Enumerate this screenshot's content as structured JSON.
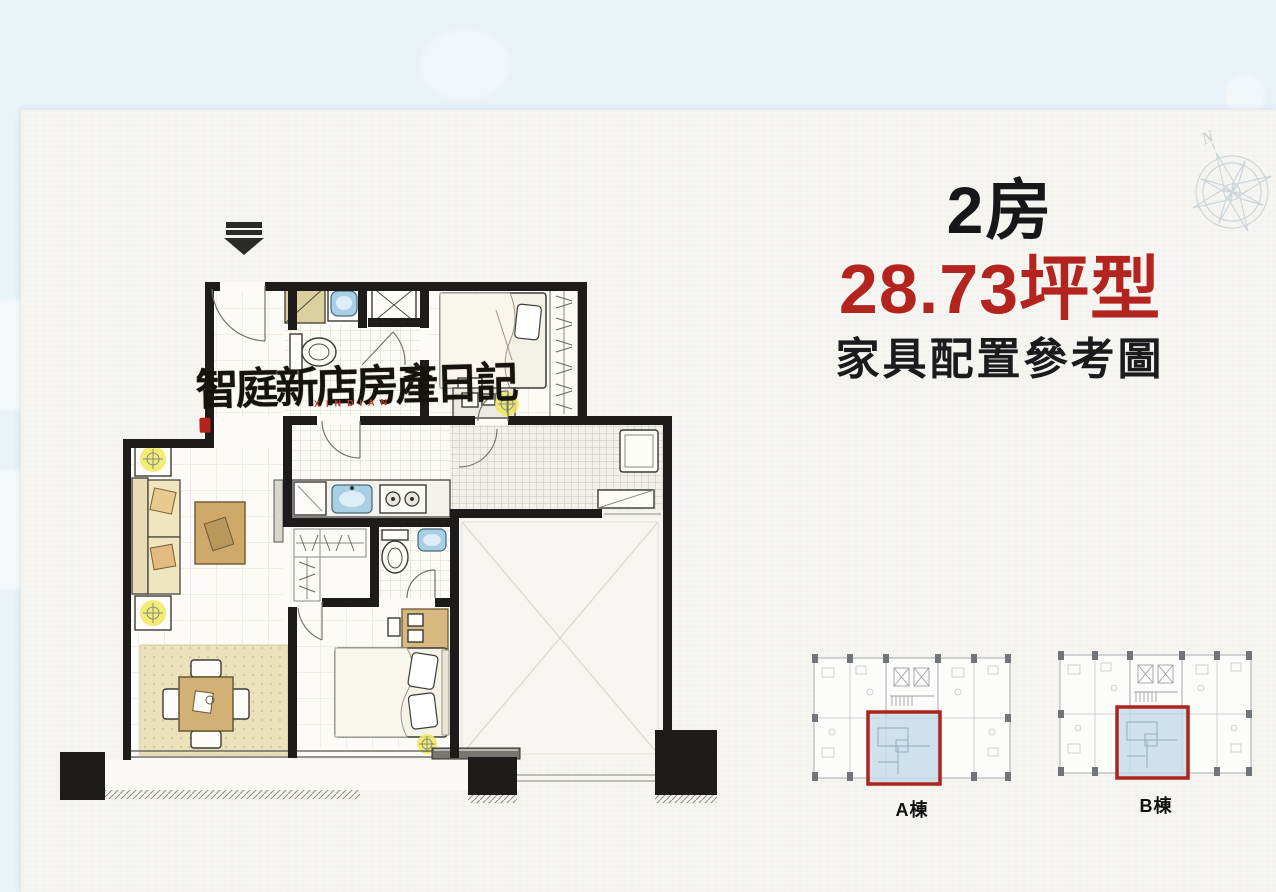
{
  "header": {
    "rooms_label": "2房",
    "area_label": "28.73坪型",
    "subtitle": "家具配置參考圖"
  },
  "watermark": {
    "text": "智庭新店房產日記",
    "subtext": "XINDIAN"
  },
  "compass": {
    "north_label": "N"
  },
  "key_plans": [
    {
      "label": "A棟"
    },
    {
      "label": "B棟"
    }
  ],
  "colors": {
    "accent_red": "#b3241e",
    "title_black": "#17171a",
    "page_blue": "#e9f2f6",
    "paper": "#f6f5f2",
    "wall": "#1d1c1a",
    "highlight_fill": "#c3d9e9",
    "highlight_border": "#ad241c",
    "lamp_yellow": "#efe95f",
    "fixture_blue": "#a9cfe4",
    "wood": "#cfa96a",
    "rug": "#e9e2ba"
  }
}
